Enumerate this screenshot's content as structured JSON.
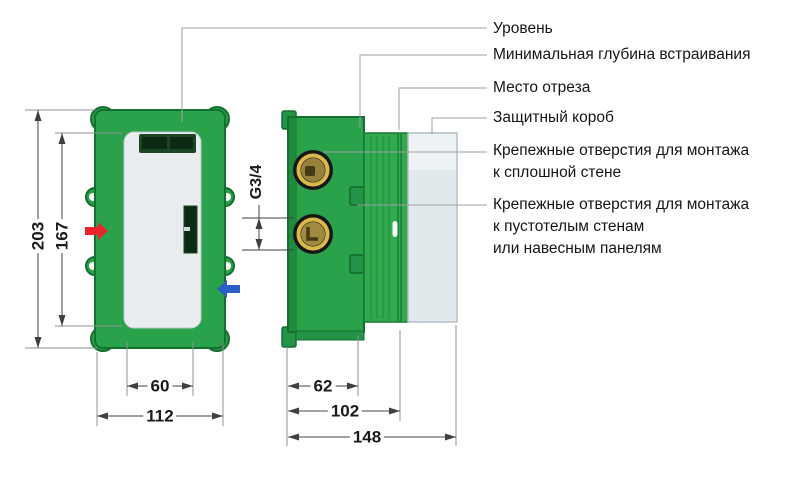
{
  "callouts": [
    {
      "lines": [
        "Уровень"
      ]
    },
    {
      "lines": [
        "Минимальная глубина встраивания"
      ]
    },
    {
      "lines": [
        "Место отреза"
      ]
    },
    {
      "lines": [
        "Защитный короб"
      ]
    },
    {
      "lines": [
        "Крепежные отверстия для монтажа",
        "к сплошной стене"
      ]
    },
    {
      "lines": [
        "Крепежные отверстия для монтажа",
        "к пустотелым стенам",
        "или навесным панелям"
      ]
    }
  ],
  "dimensions": {
    "front_outer_height": "203",
    "front_panel_height": "167",
    "front_slot_spacing": "60",
    "front_width": "112",
    "thread_size": "G3/4",
    "side_body_depth": "62",
    "side_cut_depth": "102",
    "side_total_depth": "148"
  },
  "colors": {
    "body_green": "#2aa24b",
    "body_green_dark": "#13702e",
    "ridge_green": "#31a94f",
    "hot_water_arrow": "#e8262a",
    "cold_water_arrow": "#2b5fc7",
    "brass_ring": "#d9b94b",
    "protective_box": "#e2e9ed"
  }
}
